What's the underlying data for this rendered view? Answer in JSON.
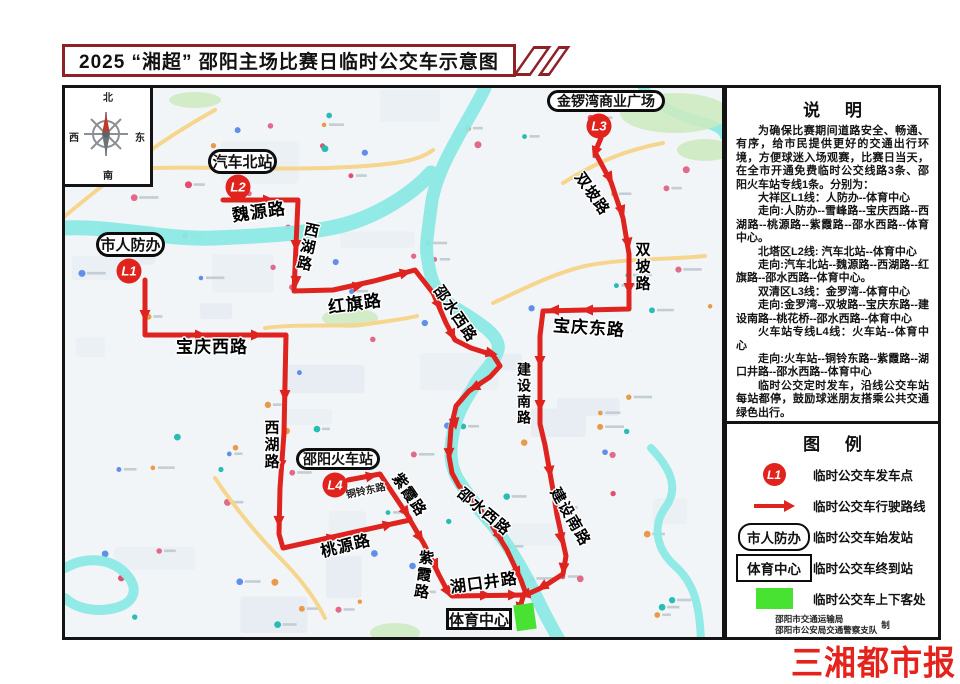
{
  "title": "2025 “湘超” 邵阳主场比赛日临时公交车示意图",
  "compass": {
    "north": "北",
    "south": "南",
    "west": "西",
    "east": "东"
  },
  "notes": {
    "heading": "说  明",
    "paragraphs": [
      "为确保比赛期间道路安全、畅通、有序，给市民提供更好的交通出行环境，方便球迷入场观赛，比赛日当天，在全市开通免费临时公交线路3条、邵阳火车站专线1条。分别为：",
      "大祥区L1线：人防办--体育中心",
      "走向:人防办--雪峰路--宝庆西路--西湖路--桃源路--紫霞路--邵水西路--体育中心。",
      "北塔区L2线: 汽车北站--体育中心",
      "走向:汽车北站--魏源路--西湖路--红旗路--邵水西路--体育中心。",
      "双清区L3线：金罗湾--体育中心",
      "走向:金罗湾--双坡路--宝庆东路--建设南路--桃花桥--邵水西路--体育中心",
      "火车站专线L4线：火车站--体育中心",
      "走向:火车站--铜铃东路--紫霞路--湖口井路--邵水西路--体育中心",
      "临时公交定时发车，沿线公交车站每站都停，鼓励球迷朋友搭乘公共交通绿色出行。"
    ]
  },
  "legend": {
    "heading": "图  例",
    "items": [
      {
        "type": "marker",
        "symbol_text": "L1",
        "label": "临时公交车发车点"
      },
      {
        "type": "arrow",
        "label": "临时公交车行驶路线"
      },
      {
        "type": "pill",
        "symbol_text": "市人防办",
        "label": "临时公交车始发站"
      },
      {
        "type": "rect",
        "symbol_text": "体育中心",
        "label": "临时公交车终到站"
      },
      {
        "type": "zone",
        "label": "临时公交车上下客处"
      }
    ],
    "credits": [
      "邵阳市交通运输局",
      "邵阳市公安局交通警察支队"
    ],
    "credits_suffix": "制"
  },
  "branding": {
    "logo": "三湘都市报"
  },
  "colors": {
    "route": "#df231e",
    "marker": "#e0231d",
    "boarding_zone": "#48e232",
    "title_border": "#8e2126",
    "logo": "#e5231c",
    "river": "#8ce9e5",
    "road_yellow": "#f6d58d",
    "map_bg": "#f2f5f8"
  },
  "map": {
    "stations": [
      {
        "name": "市人防办",
        "shape": "pill",
        "x": 31,
        "y": 144,
        "w": 69,
        "h": 25,
        "fs": 15
      },
      {
        "name": "汽车北站",
        "shape": "pill",
        "x": 143,
        "y": 61,
        "w": 69,
        "h": 25,
        "fs": 15
      },
      {
        "name": "金锣湾商业广场",
        "shape": "pill",
        "x": 482,
        "y": 2,
        "w": 118,
        "h": 22,
        "fs": 14
      },
      {
        "name": "邵阳火车站",
        "shape": "pill",
        "x": 231,
        "y": 360,
        "w": 84,
        "h": 22,
        "fs": 14
      },
      {
        "name": "体育中心",
        "shape": "rect",
        "x": 381,
        "y": 520,
        "w": 66,
        "h": 22,
        "fs": 15
      }
    ],
    "markers": [
      {
        "id": "L1",
        "x": 64,
        "y": 183
      },
      {
        "id": "L2",
        "x": 173,
        "y": 99
      },
      {
        "id": "L3",
        "x": 534,
        "y": 38
      },
      {
        "id": "L4",
        "x": 270,
        "y": 397
      }
    ],
    "road_labels": [
      {
        "name": "魏源路",
        "x": 194,
        "y": 124,
        "rot": -8,
        "size": 17
      },
      {
        "name": "西湖路",
        "x": 242,
        "y": 159,
        "rot": 12,
        "size": 15,
        "vertical": true
      },
      {
        "name": "红旗路",
        "x": 290,
        "y": 216,
        "rot": -8,
        "size": 17
      },
      {
        "name": "邵水西路",
        "x": 390,
        "y": 226,
        "rot": 56,
        "size": 15
      },
      {
        "name": "宝庆西路",
        "x": 147,
        "y": 259,
        "rot": 0,
        "size": 17
      },
      {
        "name": "西湖路",
        "x": 206,
        "y": 357,
        "rot": 0,
        "size": 15,
        "vertical": true
      },
      {
        "name": "桃源路",
        "x": 281,
        "y": 459,
        "rot": -14,
        "size": 16
      },
      {
        "name": "紫霞路",
        "x": 344,
        "y": 407,
        "rot": 56,
        "size": 15
      },
      {
        "name": "紫霞路",
        "x": 358,
        "y": 487,
        "rot": 8,
        "size": 15,
        "vertical": true
      },
      {
        "name": "湖口井路",
        "x": 419,
        "y": 496,
        "rot": -8,
        "size": 16
      },
      {
        "name": "邵水西路",
        "x": 419,
        "y": 424,
        "rot": 40,
        "size": 15
      },
      {
        "name": "铜铃东路",
        "x": 301,
        "y": 404,
        "rot": -12,
        "size": 10,
        "small": true
      },
      {
        "name": "宝庆东路",
        "x": 524,
        "y": 240,
        "rot": 4,
        "size": 17
      },
      {
        "name": "双坡路",
        "x": 527,
        "y": 106,
        "rot": 55,
        "size": 15
      },
      {
        "name": "双坡路",
        "x": 577,
        "y": 179,
        "rot": 0,
        "size": 15,
        "vertical": true
      },
      {
        "name": "建设南路",
        "x": 459,
        "y": 306,
        "rot": 0,
        "size": 14,
        "vertical": true
      },
      {
        "name": "建设南路",
        "x": 505,
        "y": 429,
        "rot": 60,
        "size": 15
      }
    ],
    "route_arrows": [
      [
        198,
        112,
        0
      ],
      [
        231,
        152,
        90
      ],
      [
        231,
        188,
        91
      ],
      [
        288,
        199,
        -12
      ],
      [
        335,
        186,
        -13
      ],
      [
        371,
        212,
        58
      ],
      [
        385,
        242,
        65
      ],
      [
        421,
        264,
        12
      ],
      [
        414,
        297,
        155
      ],
      [
        389,
        330,
        80
      ],
      [
        384,
        360,
        88
      ],
      [
        399,
        404,
        48
      ],
      [
        432,
        444,
        55
      ],
      [
        450,
        480,
        62
      ],
      [
        80,
        222,
        90
      ],
      [
        130,
        247,
        0
      ],
      [
        186,
        247,
        0
      ],
      [
        220,
        302,
        91
      ],
      [
        216,
        372,
        92
      ],
      [
        214,
        428,
        91
      ],
      [
        262,
        451,
        -12
      ],
      [
        318,
        438,
        -13
      ],
      [
        352,
        445,
        57
      ],
      [
        368,
        472,
        64
      ],
      [
        380,
        499,
        60
      ],
      [
        415,
        507,
        0
      ],
      [
        443,
        507,
        0
      ],
      [
        532,
        59,
        110
      ],
      [
        542,
        85,
        60
      ],
      [
        555,
        118,
        70
      ],
      [
        562,
        150,
        80
      ],
      [
        564,
        195,
        90
      ],
      [
        528,
        222,
        180
      ],
      [
        494,
        222,
        180
      ],
      [
        475,
        268,
        90
      ],
      [
        475,
        312,
        90
      ],
      [
        484,
        378,
        82
      ],
      [
        495,
        445,
        80
      ],
      [
        499,
        475,
        95
      ],
      [
        482,
        496,
        150
      ],
      [
        465,
        505,
        167
      ],
      [
        301,
        389,
        -10
      ],
      [
        338,
        420,
        54
      ],
      [
        456,
        515,
        108
      ]
    ],
    "boarding_zone": {
      "x": 450,
      "y": 516,
      "w": 20,
      "h": 26,
      "rot": -8
    }
  }
}
